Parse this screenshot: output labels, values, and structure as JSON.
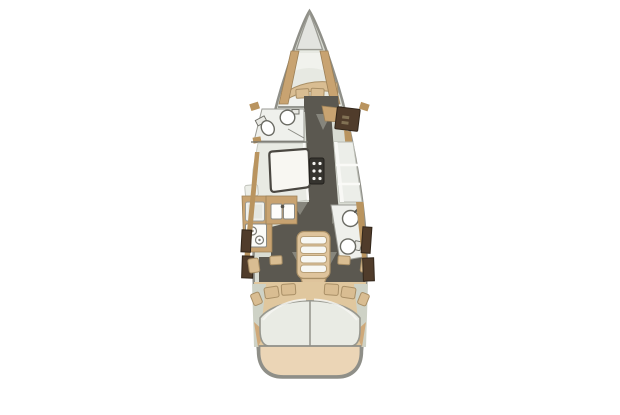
{
  "page": {
    "title": "sailboat-interior-floor-plan"
  },
  "diagram": {
    "type": "yacht-deck-plan",
    "orientation": "bow-up",
    "features": [
      "bow-deck",
      "v-berth-cabin",
      "v-berth-blanket",
      "v-berth-pillows",
      "forward-head-sink",
      "forward-head-toilet",
      "starboard-cabinet",
      "salon-table",
      "salon-port-settee",
      "salon-starboard-settee",
      "centerline-folding-leaf",
      "walkway-sole",
      "galley-fridge",
      "galley-double-sink",
      "galley-stove",
      "aft-head-sink",
      "aft-head-toilet",
      "companionway-steps",
      "port-aft-berth",
      "starboard-aft-berth",
      "aft-berth-pillows",
      "aft-cabin-stools",
      "swim-platform"
    ]
  },
  "colors": {
    "background": "#ffffff",
    "hull_outline": "#8f8f88",
    "deck": "#d9dcd3",
    "bow_deck": "#e3e4e0",
    "berth": "#e7e9e2",
    "foot_white": "#f0f1ed",
    "wood": "#c8a371",
    "wood_mid": "#b9945f",
    "cabinet": "#503c2b",
    "sole": "#5b5850",
    "door_swing": "#a9aba1",
    "floor_white": "#eff0ec",
    "fixture": "#ffffff",
    "fixture_outline": "#6b6b64",
    "cushion": "#d9bd92",
    "surface": "#e8eae3",
    "seat": "#eceee9",
    "table": "#f8f7f2",
    "table_border": "#4a4741",
    "leaf": "#35332e",
    "step_frame": "#dfc49c",
    "step_tread": "#f7f7f3",
    "mattress": "#e9ebe4",
    "transom": "#ebd5b6",
    "sage": "#ced2c6"
  }
}
